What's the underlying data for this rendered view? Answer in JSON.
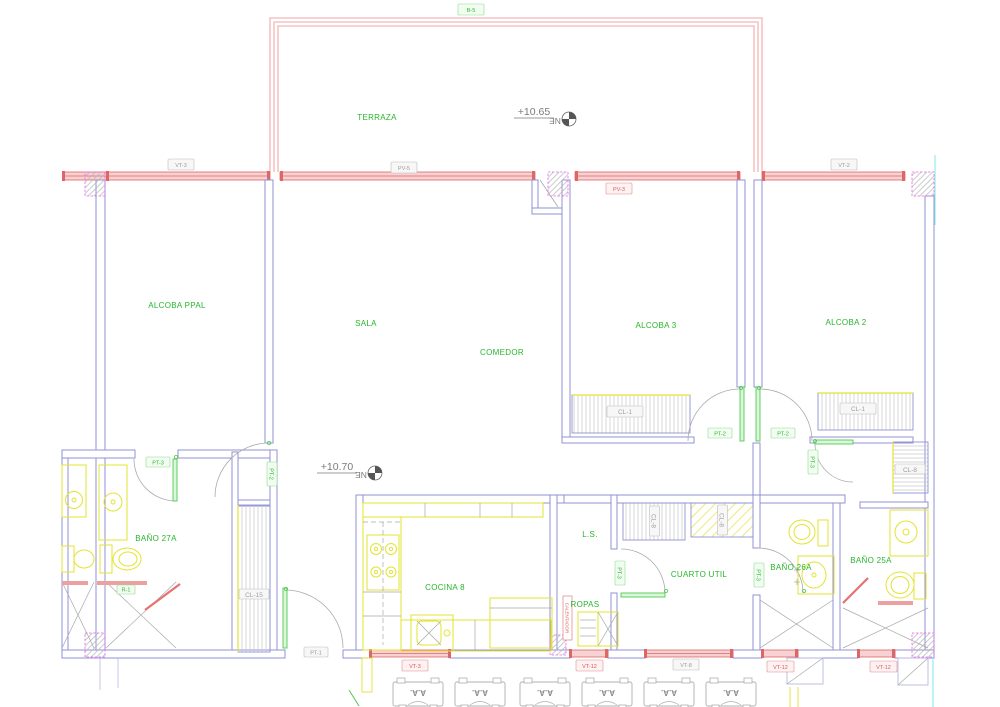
{
  "drawing": {
    "rooms": {
      "terraza": "TERRAZA",
      "alcoba_ppal": "ALCOBA PPAL",
      "sala": "SALA",
      "comedor": "COMEDOR",
      "alcoba3": "ALCOBA 3",
      "alcoba2": "ALCOBA 2",
      "bano27a": "BAÑO 27A",
      "cocina8": "COCINA 8",
      "ls": "L.S.",
      "ropas": "ROPAS",
      "cuarto_util": "CUARTO UTIL",
      "bano26a": "BAÑO 26A",
      "bano25a": "BAÑO 25A"
    },
    "levels": {
      "terraza": "+10.65",
      "interior": "+10.70"
    },
    "north_label": "NE",
    "tags": {
      "b5": "B-5",
      "vt3_top": "VT-3",
      "pv5": "PV-5",
      "vt2": "VT-2",
      "pv3": "PV-3",
      "pt1": "PT-1",
      "pt2": "PT-2",
      "pt3": "PT-3",
      "cl1": "CL-1",
      "cl8": "CL-8",
      "cl15": "CL-15",
      "vt3_bottom": "VT-3",
      "vt12": "VT-12",
      "vt8": "VT-8",
      "r1": "R-1",
      "calentador": "CALENTADOR",
      "ac_unit": "A.A."
    },
    "colors": {
      "wall_blue": "#9191d4",
      "window_red": "#dd6666",
      "terrace_pink": "#f2a6a6",
      "label_green": "#27b52b",
      "fixture_yellow": "#e3e330",
      "hatch_gray": "#c6c6c6",
      "column_magenta": "#ee66ee",
      "cyan": "#7fe9e9",
      "tag_red": "#d95c5c",
      "tag_gray": "#9a9a9a"
    }
  }
}
